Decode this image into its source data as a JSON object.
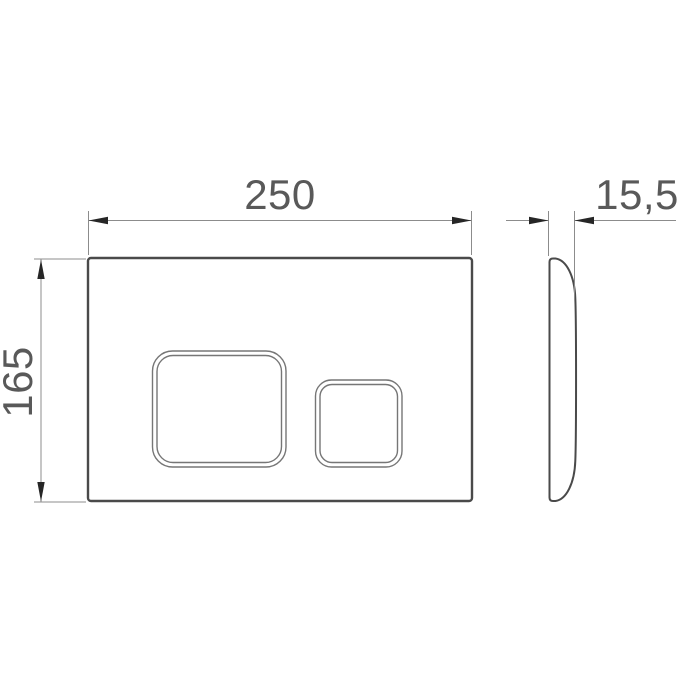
{
  "drawing": {
    "dimensions": {
      "width_label": "250",
      "height_label": "165",
      "depth_label": "15,5"
    },
    "colors": {
      "outline": "#4a4a4a",
      "button_outline": "#767676",
      "thin_line": "#8c8c8c",
      "arrow": "#262626",
      "text": "#595959",
      "background": "#ffffff"
    }
  }
}
